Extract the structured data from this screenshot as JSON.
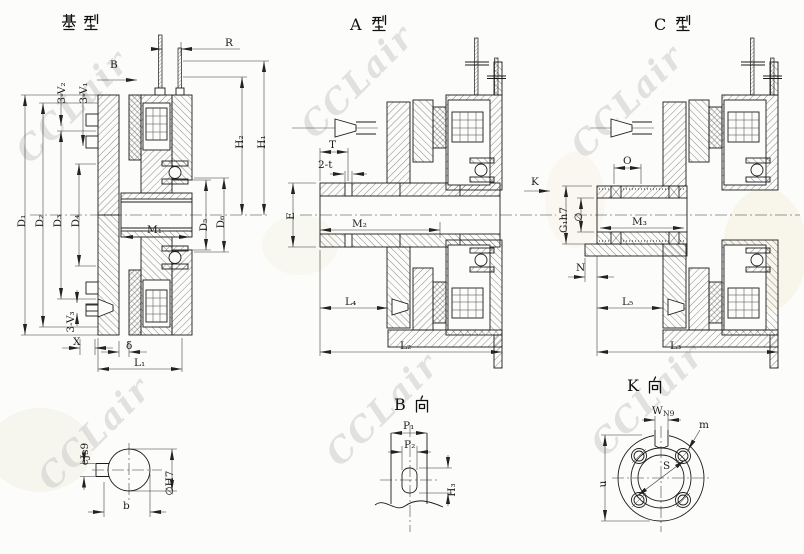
{
  "watermark": {
    "text": "CCLair",
    "color": "#cbcbcb"
  },
  "titles": {
    "base": "基型",
    "a": "A 型",
    "c": "C 型",
    "b": "B 向",
    "k": "K 向",
    "a_letter": "A",
    "b_letter": "B",
    "c_letter": "C",
    "k_letter": "K"
  },
  "base_view": {
    "labels": {
      "b_dir": "B",
      "r": "R",
      "v2": "3-V₂",
      "v1": "3-V₁",
      "v3": "3-V₃",
      "h1": "H₁",
      "h2": "H₂",
      "d1": "D₁",
      "d2": "D₂",
      "d3": "D₃",
      "d4": "D₄",
      "d5": "D₅",
      "d6": "D₆",
      "m1": "M₁",
      "x": "X",
      "delta": "δ",
      "l1": "L₁"
    }
  },
  "a_view": {
    "labels": {
      "t": "T",
      "two_t": "2-t",
      "e": "E",
      "m2": "M₂",
      "l4": "L₄",
      "l2": "L₂",
      "k_dir": "K"
    }
  },
  "c_view": {
    "labels": {
      "o": "O",
      "g1": "G₁h7",
      "phi": "∅",
      "m3": "M₃",
      "n": "N",
      "l5": "L₅",
      "l3": "L₃"
    }
  },
  "bore_view": {
    "labels": {
      "e_key": "eJs9",
      "dia": "∅H7",
      "b": "b"
    }
  },
  "b_view": {
    "labels": {
      "p1": "P₁",
      "p2": "P₂",
      "h3": "H₃"
    }
  },
  "k_view": {
    "labels": {
      "w": "W",
      "n9": "N9",
      "m": "m",
      "u": "u",
      "s": "S"
    }
  }
}
